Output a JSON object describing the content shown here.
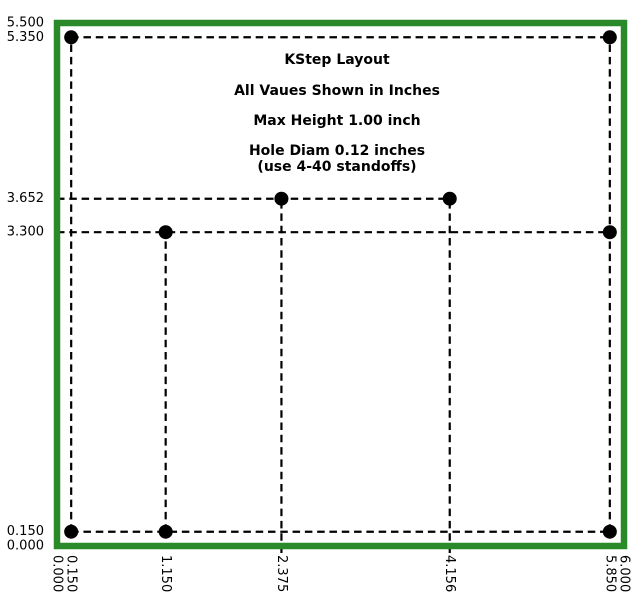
{
  "figure": {
    "width_px": 644,
    "height_px": 598,
    "background": "#ffffff"
  },
  "colors": {
    "board_outline": "#2a8a2a",
    "hole_fill": "#000000",
    "dashed_line": "#000000",
    "text": "#000000"
  },
  "chart_data": {
    "type": "scatter",
    "title": "KStep Layout",
    "units": "inches",
    "xlim": [
      0,
      6
    ],
    "ylim": [
      0,
      5.5
    ],
    "grid": false,
    "legend": "none",
    "annotations": [
      {
        "text": "KStep Layout",
        "x": 2.963,
        "y": 5.111
      },
      {
        "text": "All Vaues Shown in Inches",
        "x": 2.963,
        "y": 4.785
      },
      {
        "text": "Max Height 1.00 inch",
        "x": 2.963,
        "y": 4.469
      },
      {
        "text": "Hole Diam 0.12 inches",
        "x": 2.963,
        "y": 4.154
      },
      {
        "text": "(use 4-40 standoffs)",
        "x": 2.963,
        "y": 3.986
      }
    ],
    "x_ticks": [
      {
        "label": "0.000",
        "value": 0.0
      },
      {
        "label": "0.150",
        "value": 0.15
      },
      {
        "label": "1.150",
        "value": 1.15
      },
      {
        "label": "2.375",
        "value": 2.375
      },
      {
        "label": "4.156",
        "value": 4.156
      },
      {
        "label": "5.850",
        "value": 5.85
      },
      {
        "label": "6.000",
        "value": 6.0
      }
    ],
    "y_ticks": [
      {
        "label": "5.500",
        "value": 5.5
      },
      {
        "label": "5.350",
        "value": 5.35
      },
      {
        "label": "3.652",
        "value": 3.652
      },
      {
        "label": "3.300",
        "value": 3.3
      },
      {
        "label": "0.150",
        "value": 0.15
      },
      {
        "label": "0.000",
        "value": 0.0
      }
    ],
    "board_outline": {
      "x0": 0,
      "y0": 0,
      "x1": 6,
      "y1": 5.5
    },
    "holes": {
      "diameter_inches": 0.12,
      "points": [
        [
          0.15,
          5.35
        ],
        [
          5.85,
          5.35
        ],
        [
          2.375,
          3.652
        ],
        [
          4.156,
          3.652
        ],
        [
          1.15,
          3.3
        ],
        [
          5.85,
          3.3
        ],
        [
          0.15,
          0.15
        ],
        [
          1.15,
          0.15
        ],
        [
          5.85,
          0.15
        ]
      ]
    },
    "dashed_lines": [
      {
        "x1": 0.15,
        "y1": 5.35,
        "x2": 5.85,
        "y2": 5.35
      },
      {
        "x1": 0.0,
        "y1": 3.652,
        "x2": 4.156,
        "y2": 3.652
      },
      {
        "x1": 0.0,
        "y1": 3.3,
        "x2": 5.85,
        "y2": 3.3
      },
      {
        "x1": 0.15,
        "y1": 0.15,
        "x2": 5.85,
        "y2": 0.15
      },
      {
        "x1": 0.15,
        "y1": 0.15,
        "x2": 0.15,
        "y2": 5.35
      },
      {
        "x1": 1.15,
        "y1": 0.15,
        "x2": 1.15,
        "y2": 3.3
      },
      {
        "x1": 2.375,
        "y1": 0.0,
        "x2": 2.375,
        "y2": 3.652
      },
      {
        "x1": 4.156,
        "y1": 0.0,
        "x2": 4.156,
        "y2": 3.652
      },
      {
        "x1": 5.85,
        "y1": 0.15,
        "x2": 5.85,
        "y2": 5.35
      }
    ]
  }
}
